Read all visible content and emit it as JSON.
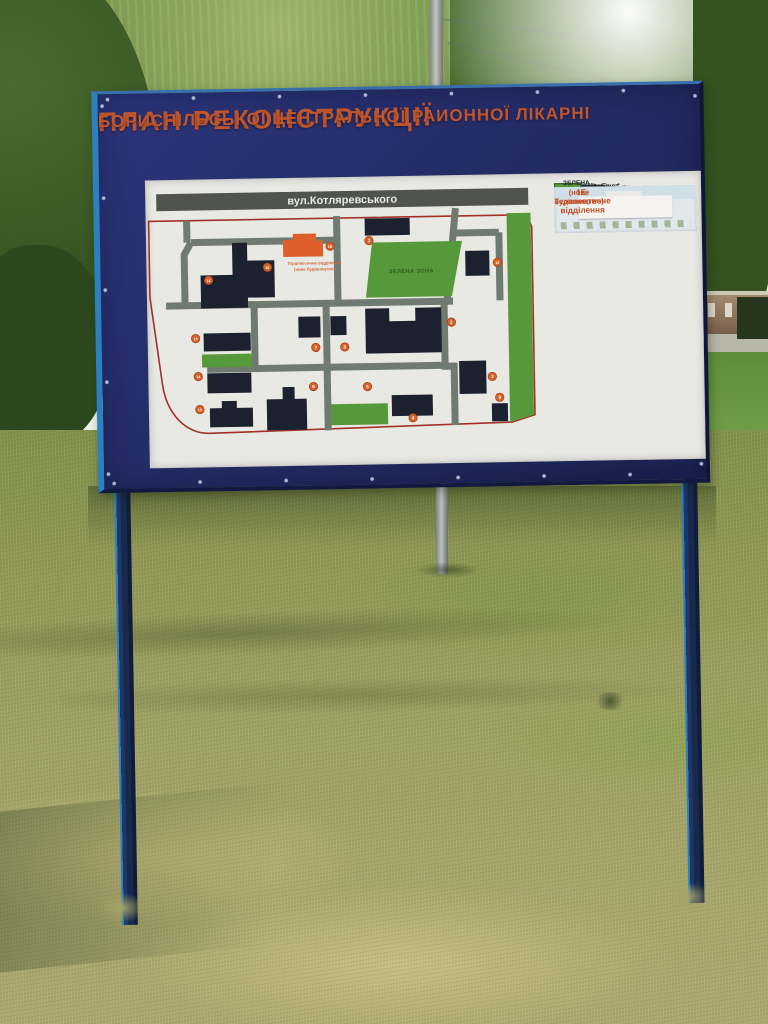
{
  "board": {
    "title_line1": "ПЛАН РЕКОНСТРУКЦІЇ",
    "title_line2": "БОРИСПІЛЬСЬКОЇ ЦЕНТРАЛЬНОЇ РАИОННОЇ ЛІКАРНІ"
  },
  "map": {
    "street_label": "вул.Котляревського",
    "green_zone_label": "ЗЕЛЕНА ЗОНА",
    "new_building_label_line1": "Терапевтичне відділення",
    "new_building_label_line2": "(нове будівництво)",
    "markers": [
      {
        "id": "1",
        "x": 222,
        "y": 63
      },
      {
        "id": "1Е",
        "x": 183,
        "y": 68
      },
      {
        "id": "2",
        "x": 303,
        "y": 146
      },
      {
        "id": "3",
        "x": 343,
        "y": 201
      },
      {
        "id": "4",
        "x": 263,
        "y": 241
      },
      {
        "id": "5",
        "x": 218,
        "y": 209
      },
      {
        "id": "6",
        "x": 164,
        "y": 208
      },
      {
        "id": "7",
        "x": 167,
        "y": 169
      },
      {
        "id": "8",
        "x": 196,
        "y": 169
      },
      {
        "id": "9",
        "x": 350,
        "y": 222
      },
      {
        "id": "10",
        "x": 120,
        "y": 88
      },
      {
        "id": "11",
        "x": 61,
        "y": 100
      },
      {
        "id": "12",
        "x": 350,
        "y": 87
      },
      {
        "id": "13",
        "x": 47,
        "y": 158
      },
      {
        "id": "14",
        "x": 49,
        "y": 196
      },
      {
        "id": "15",
        "x": 50,
        "y": 229
      }
    ]
  },
  "legend": {
    "title": "Експлікація:",
    "items": [
      {
        "num": "1.",
        "label": "Проф.мед.кабінет"
      },
      {
        "num": "2.",
        "label": "Пологове відділення",
        "label2": "Жіноча консультація"
      },
      {
        "num": "3.",
        "label": "Санепідстанція"
      },
      {
        "num": "4.",
        "label": "Неврологічне відділення"
      },
      {
        "num": "5.",
        "label": "Харчоблок"
      },
      {
        "num": "6.",
        "label": "Гараж-склад"
      },
      {
        "num": "7.",
        "label": "Морг"
      },
      {
        "num": "8.",
        "label": "Пральня"
      },
      {
        "num": "9.",
        "label": "Котельня"
      },
      {
        "num": "10.",
        "label": "Лікарський корпус"
      },
      {
        "num": "11.",
        "label": "Поліклініка"
      },
      {
        "num": "12.",
        "label": "Інфекційне відділення"
      },
      {
        "num": "13.",
        "label": "Адмінкорпус"
      },
      {
        "num": "14.",
        "label": "Терапевтичне  відділення"
      },
      {
        "num": "15.",
        "label": "Каплиця"
      }
    ],
    "green_zone_label": "ЗЕЛЕНА ЗОНА",
    "note_line1": "1Е. Терапевтичне відділення",
    "note_line2": "(нове будівництво)"
  },
  "colors": {
    "board_blue": "#242c66",
    "frame_teal": "#2e7fc0",
    "title_orange": "#c0562e",
    "panel_white": "#e9e9e4",
    "road_gray": "#6f7a70",
    "building_dark": "#1c2130",
    "green_zone": "#56993a",
    "orange_building": "#dd5f2c",
    "marker_orange": "#d4622c",
    "red_boundary": "#a23227",
    "banner_gray": "#50544c"
  }
}
